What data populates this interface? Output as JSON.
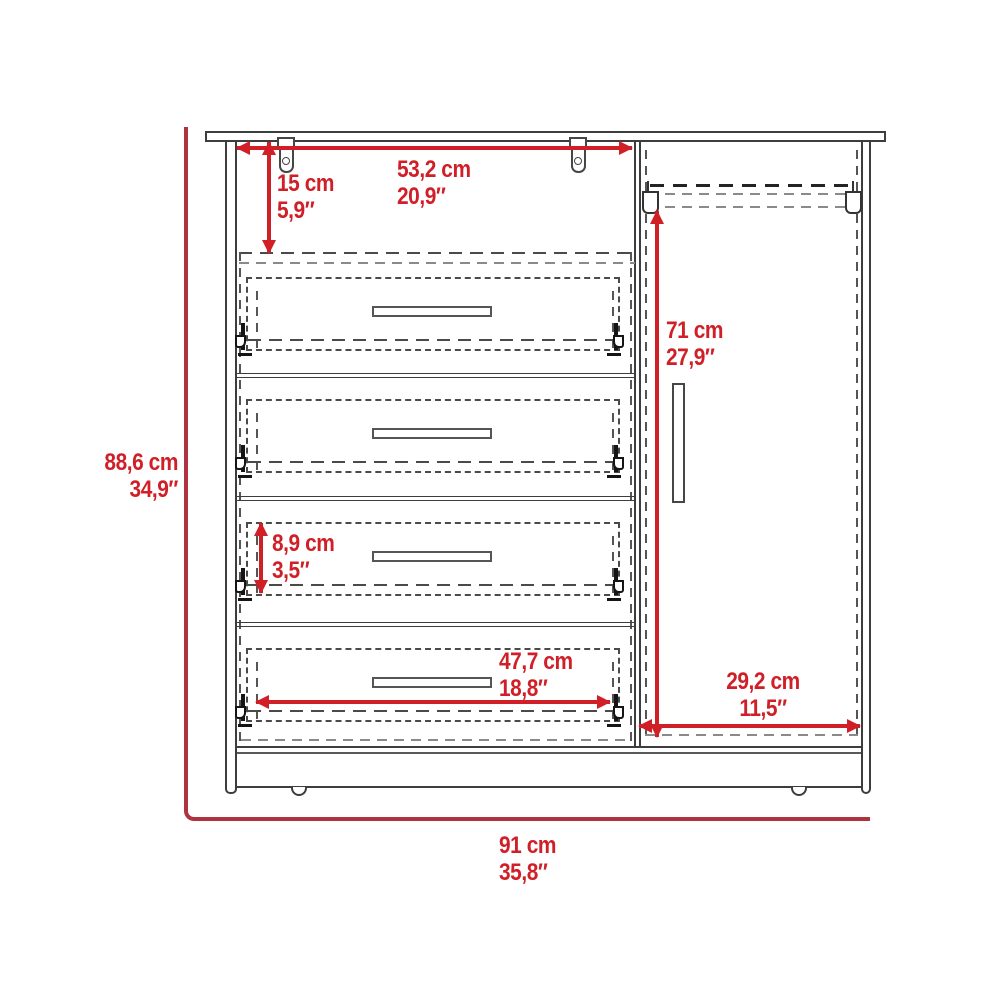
{
  "diagram": {
    "kind": "furniture dimension drawing",
    "subject": "dresser with four drawers and side door closet",
    "colors": {
      "dimension_red": "#d01f27",
      "boundary_red": "#ae3240",
      "line_gray": "#3d3d3d"
    },
    "dimensions": {
      "top_width": {
        "cm": "53,2 cm",
        "inch": "20,9″"
      },
      "top_panel_height": {
        "cm": "15 cm",
        "inch": "5,9″"
      },
      "overall_height": {
        "cm": "88,6 cm",
        "inch": "34,9″"
      },
      "door_opening_height": {
        "cm": "71 cm",
        "inch": "27,9″"
      },
      "drawer_front_height": {
        "cm": "8,9 cm",
        "inch": "3,5″"
      },
      "drawer_width": {
        "cm": "47,7 cm",
        "inch": "18,8″"
      },
      "door_opening_width": {
        "cm": "29,2 cm",
        "inch": "11,5″"
      },
      "overall_width": {
        "cm": "91 cm",
        "inch": "35,8″"
      }
    }
  }
}
